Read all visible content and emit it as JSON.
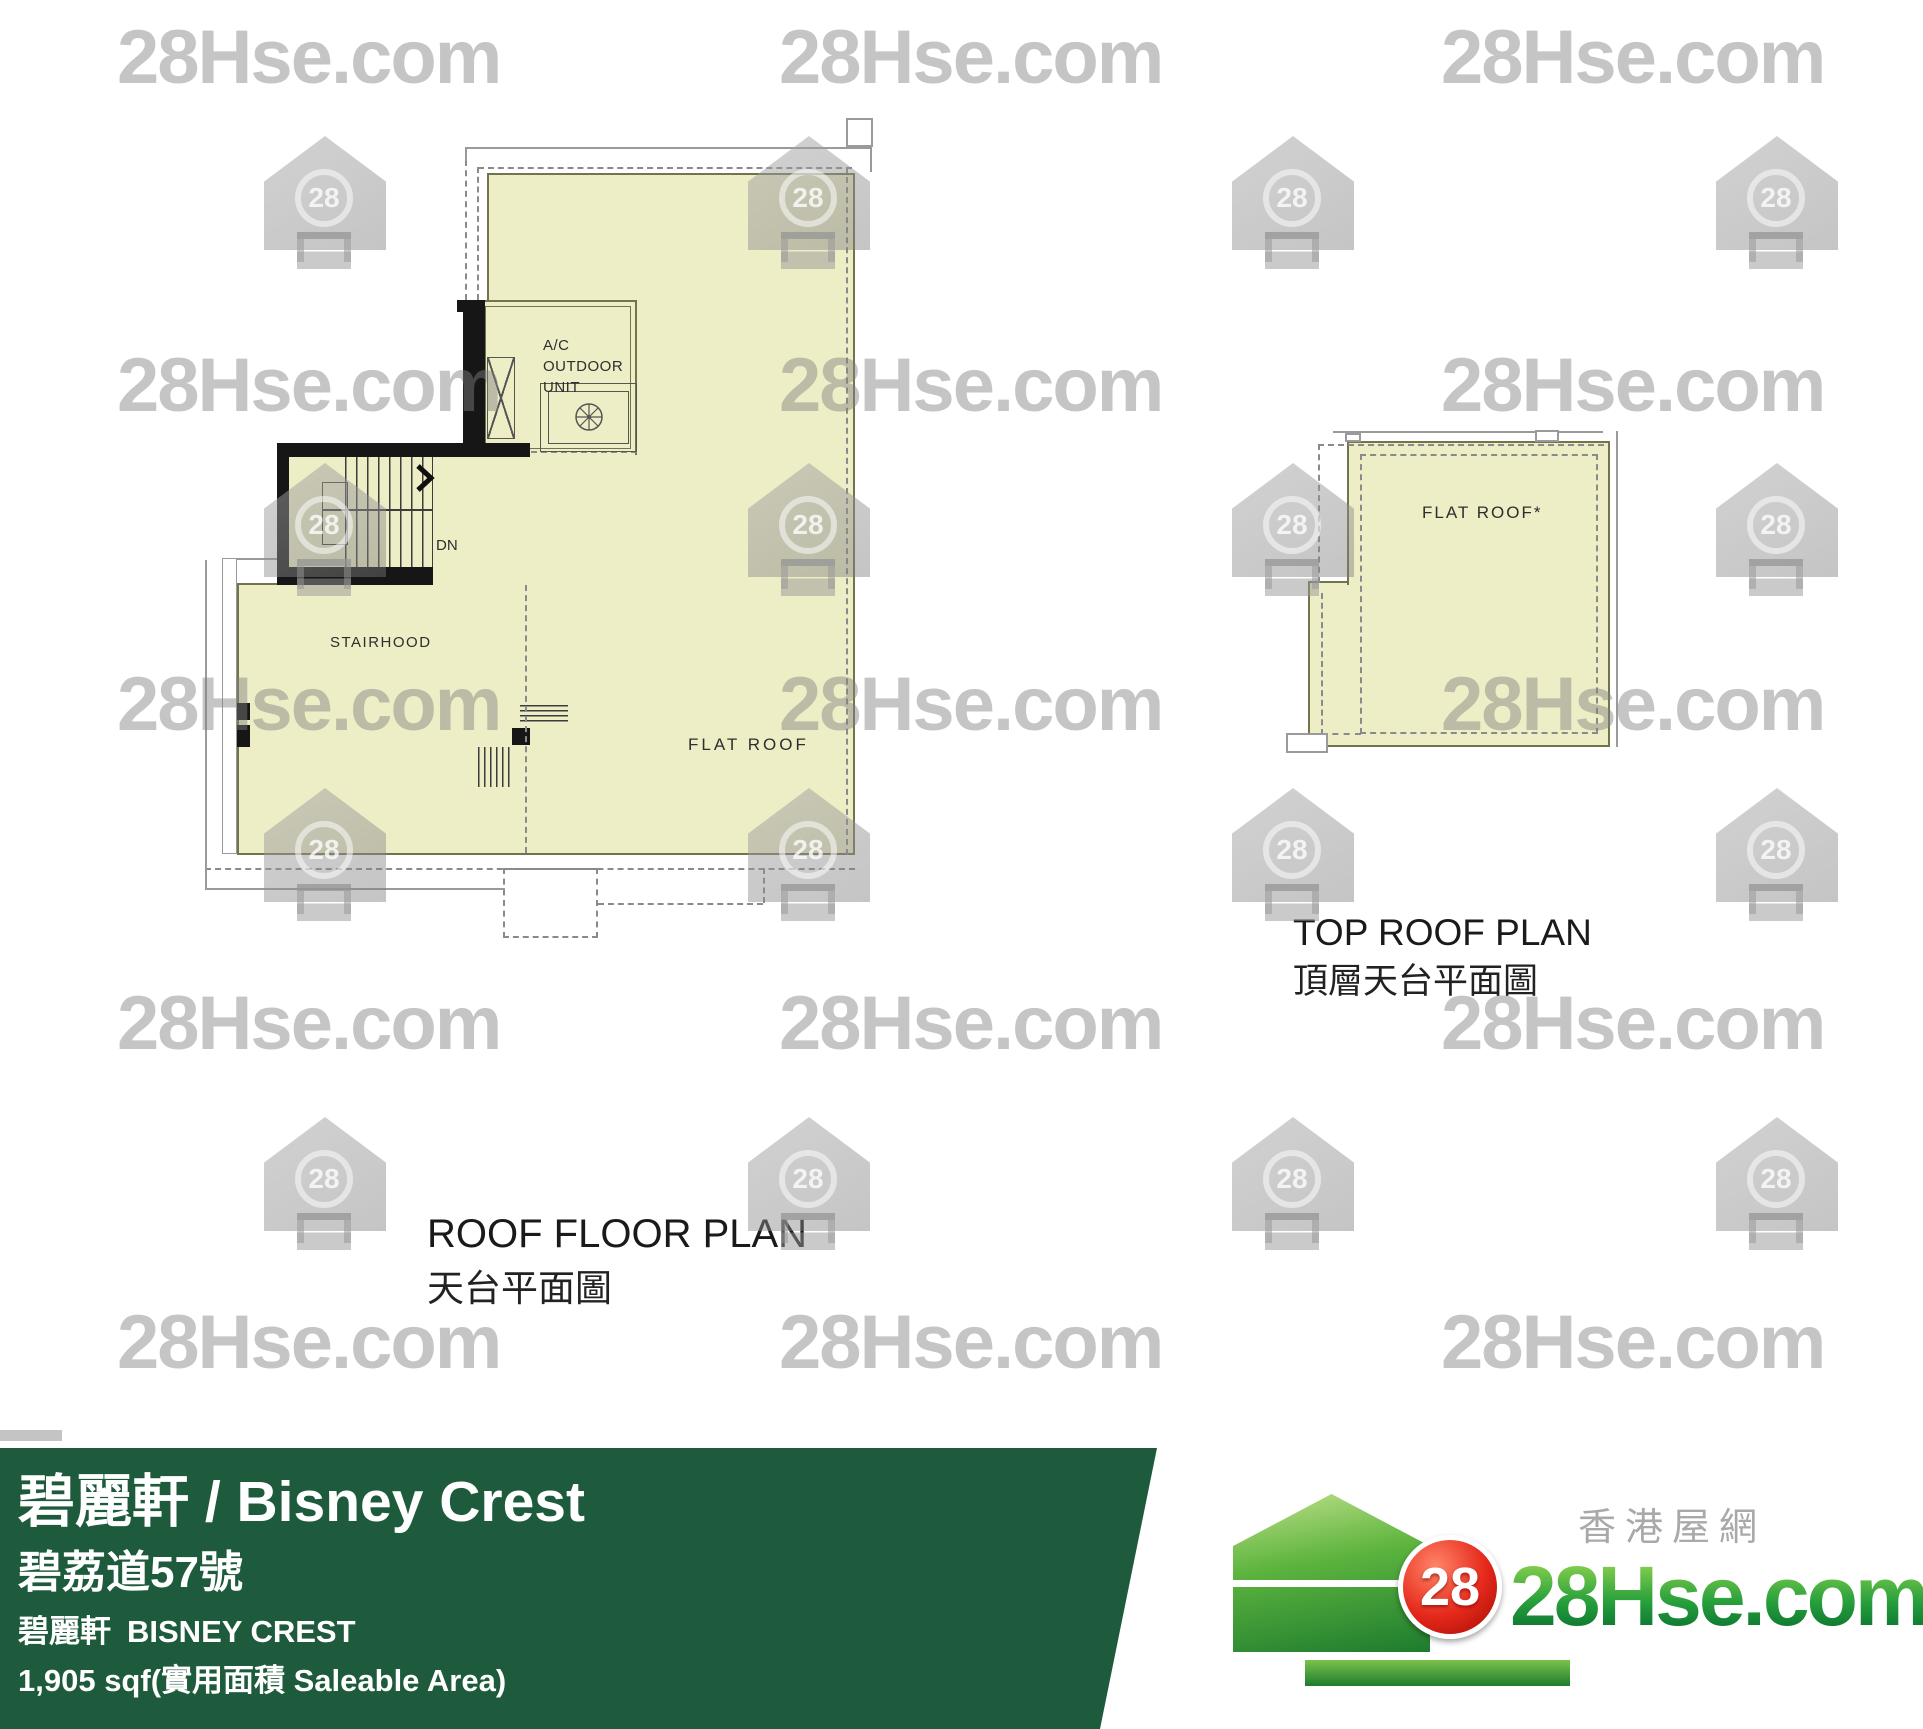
{
  "page": {
    "background": "#ffffff"
  },
  "watermark": {
    "text": "28Hse.com",
    "icon_label": "28",
    "color": "#C8C8C8"
  },
  "plans": {
    "roof": {
      "title_en": "ROOF FLOOR PLAN",
      "title_zh": "天台平面圖",
      "labels": {
        "ac_unit": "A/C\nOUTDOOR\nUNIT",
        "dn": "DN",
        "stairhood": "STAIRHOOD",
        "flat_roof": "FLAT ROOF"
      },
      "fill_color": "#EDEDC6"
    },
    "top_roof": {
      "title_en": "TOP ROOF PLAN",
      "title_zh": "頂層天台平面圖",
      "labels": {
        "flat_roof": "FLAT ROOF*"
      },
      "fill_color": "#EDEDC6"
    }
  },
  "banner": {
    "title": "碧麗軒 / Bisney Crest",
    "address_zh": "碧荔道57號",
    "name_zh": "碧麗軒",
    "name_en": "BISNEY CREST",
    "area": "1,905 sqf(實用面積 Saleable Area)",
    "bg_color": "#1E5B3C"
  },
  "logo": {
    "site_name_zh": "香港屋網",
    "site_name": "28Hse.com",
    "badge": "28",
    "green": "#2E9E3C",
    "red": "#D3281A"
  }
}
